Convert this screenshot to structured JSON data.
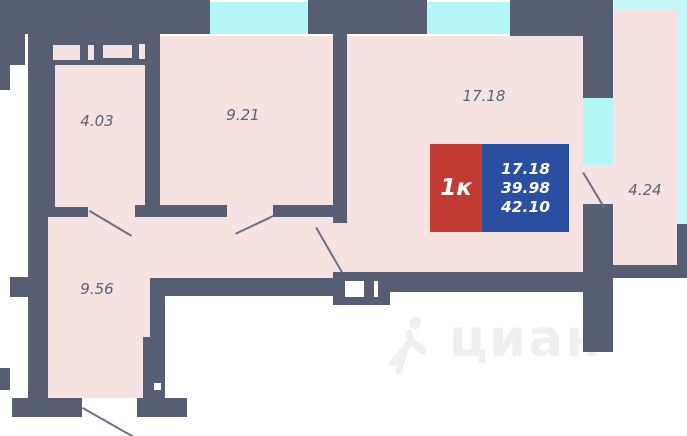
{
  "rooms": [
    {
      "id": "bathroom",
      "area": "4.03"
    },
    {
      "id": "kitchen",
      "area": "9.21"
    },
    {
      "id": "living-room",
      "area": "17.18"
    },
    {
      "id": "balcony",
      "area": "4.24"
    },
    {
      "id": "hallway",
      "area": "9.56"
    }
  ],
  "badge": {
    "type_label": "1к",
    "lines": [
      "17.18",
      "39.98",
      "42.10"
    ]
  },
  "watermark": {
    "text": "циан"
  },
  "colors": {
    "bg": "#ffffff",
    "wall": "#575d72",
    "room": "#f6e2e1",
    "window": "#b4f6f8",
    "window-light": "#c6f8fa",
    "badge-red": "#c23b33",
    "badge-blue": "#2a4fa0",
    "label": "#5b6177",
    "door": "#6b7184",
    "watermark": "#f1eeef"
  }
}
